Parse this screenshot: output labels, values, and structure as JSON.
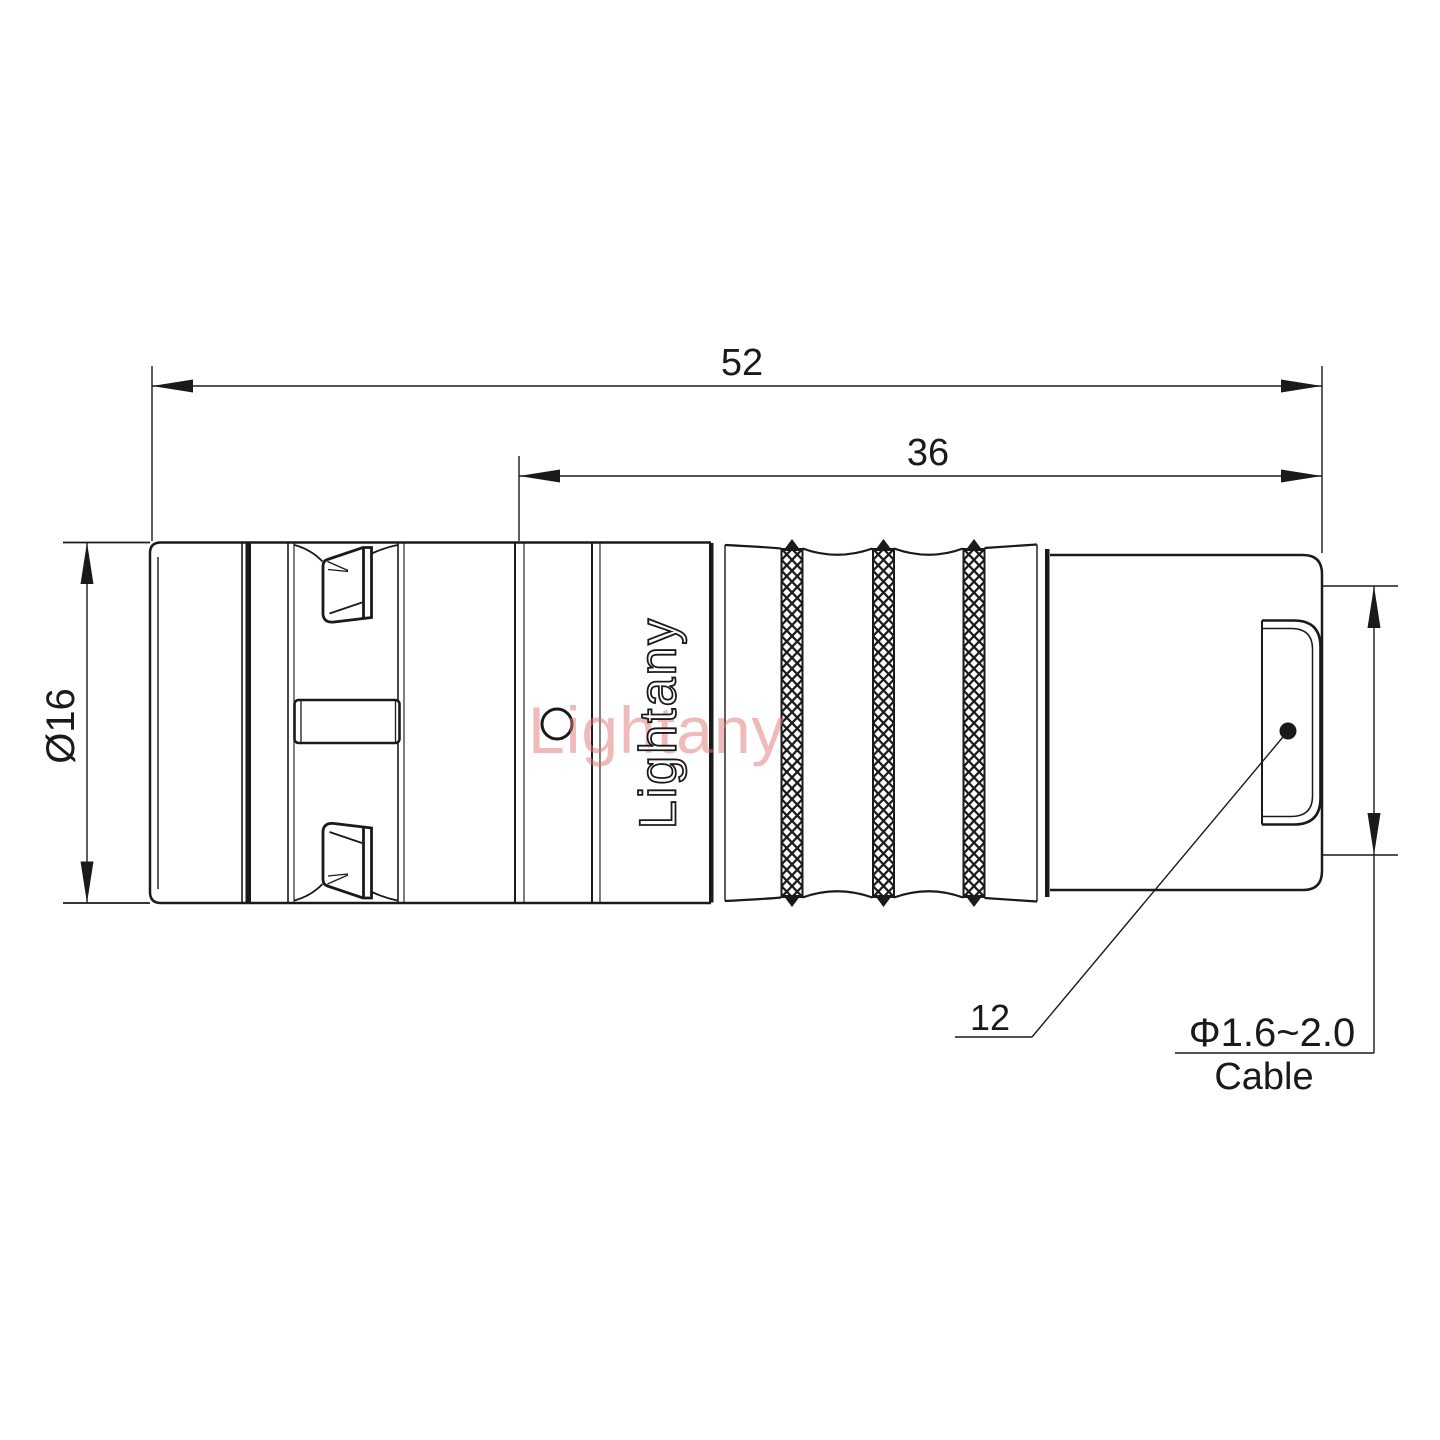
{
  "drawing": {
    "brand": "Lightany",
    "watermark": "Lightany",
    "dims": {
      "overall_length": "52",
      "back_length": "36",
      "diameter": "Ø16",
      "boot_ref": "12",
      "cable_range": "Φ1.6~2.0",
      "cable_word": "Cable"
    },
    "colors": {
      "line": "#1a1a1a",
      "watermark": "#e07878",
      "background": "#ffffff"
    }
  }
}
